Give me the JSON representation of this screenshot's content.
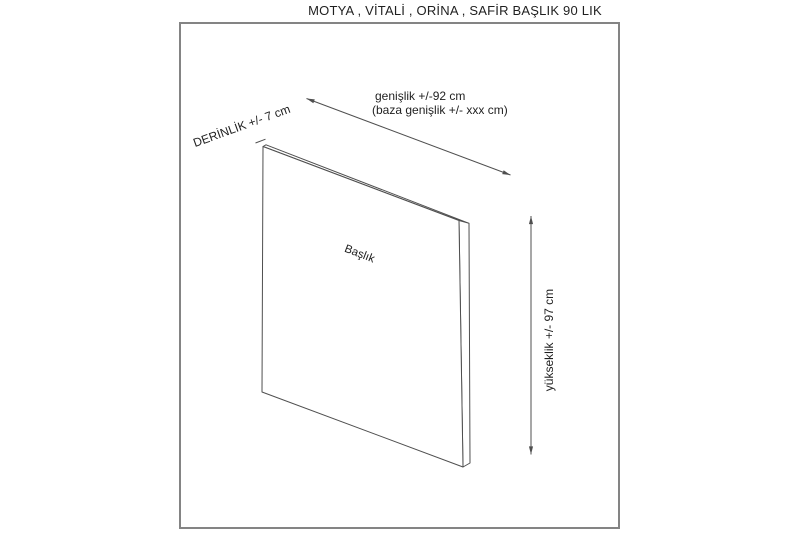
{
  "title": "MOTYA , VİTALİ , ORİNA , SAFİR BAŞLIK 90 LIK",
  "labels": {
    "depth": "DERİNLİK +/- 7 cm",
    "width_line1": "genişlik +/-92 cm",
    "width_line2": "(baza genişlik +/- xxx cm)",
    "height": "yükseklik +/- 97 cm",
    "panel": "Başlık"
  },
  "dimensions": {
    "depth_cm": "+/- 7",
    "width_cm": "+/-92",
    "base_width_cm": "+/- xxx",
    "height_cm": "+/- 97"
  },
  "colors": {
    "text": "#1f1f1f",
    "line": "#4f4f4f",
    "border": "#848484",
    "background": "#ffffff"
  }
}
